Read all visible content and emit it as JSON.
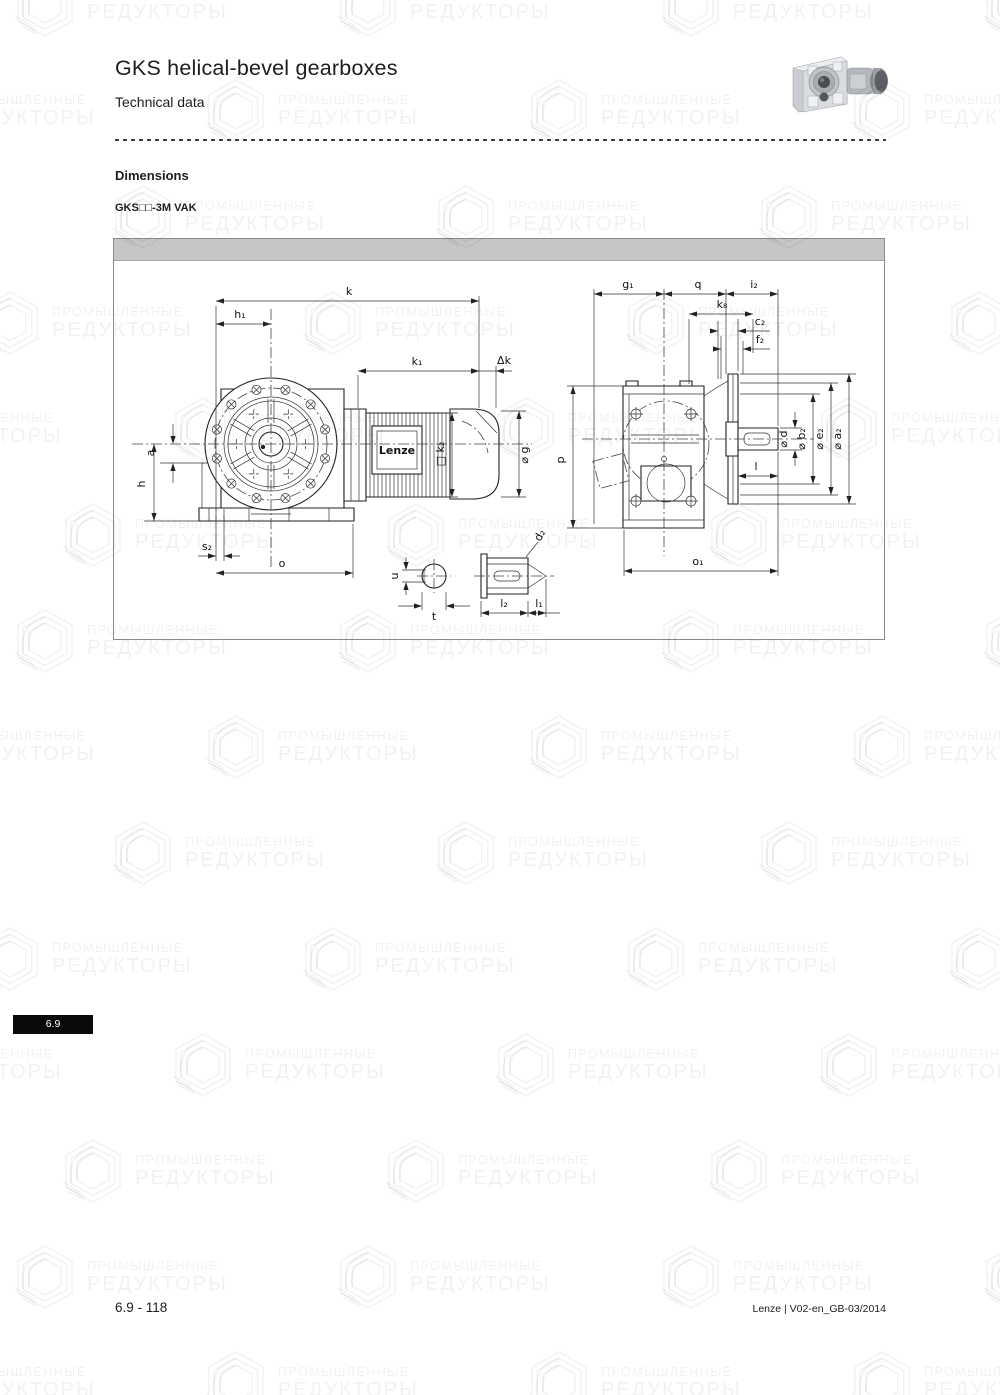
{
  "header": {
    "title": "GKS helical-bevel gearboxes",
    "subtitle": "Technical data"
  },
  "section": {
    "heading": "Dimensions",
    "variant": "GKS□□-3M VAK"
  },
  "watermark": {
    "line1": "ПРОМЫШЛЕННЫЕ",
    "line2": "РЕДУКТОРЫ"
  },
  "drawing": {
    "brand": "Lenze",
    "front": {
      "k": "k",
      "h1": "h₁",
      "k1": "k₁",
      "dk": "Δk",
      "a": "a",
      "h": "h",
      "s2": "s₂",
      "o": "o",
      "g": "⌀ g",
      "k2": "□ k₂",
      "u": "u",
      "t": "t",
      "d2": "d₂",
      "l2": "l₂",
      "l1": "l₁"
    },
    "side": {
      "g1": "g₁",
      "q": "q",
      "i2": "i₂",
      "k8": "k₈",
      "c2": "c₂",
      "f2": "f₂",
      "p": "p",
      "l": "l",
      "d": "⌀ d",
      "b2": "⌀ b₂",
      "e2": "⌀ e₂",
      "a2": "⌀ a₂",
      "o1": "o₁"
    }
  },
  "footer": {
    "chapter_tab": "6.9",
    "page_number": "6.9 - 118",
    "doc_reference": "Lenze | V02-en_GB-03/2014"
  },
  "colors": {
    "panel_header": "#c5c6c5",
    "panel_border": "#8a8a8a",
    "line": "#222222",
    "tab_bg": "#0a0a0a"
  }
}
